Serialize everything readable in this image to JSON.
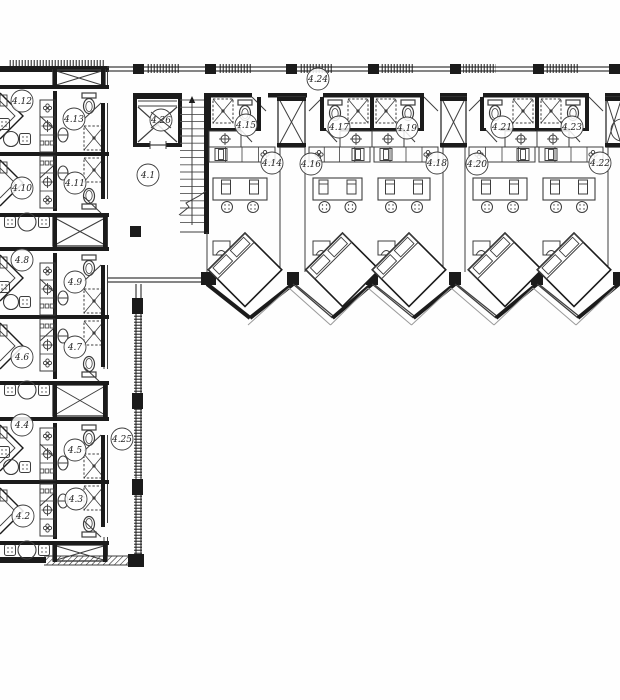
{
  "plan": {
    "type": "architectural-floor-plan",
    "colors": {
      "wall": "#1b1b1b",
      "line": "#3d3d3d",
      "mid": "#555555",
      "light": "#9a9a9a",
      "bg": "#fefefe"
    },
    "corridor_top_label": "4.24",
    "corridor_left_label": "4.25",
    "lobby_label": "4.1",
    "elevator_label": "4.26",
    "room_labels": [
      {
        "id": "4.1",
        "x": 148,
        "y": 175
      },
      {
        "id": "4.2",
        "x": 23,
        "y": 516
      },
      {
        "id": "4.3",
        "x": 76,
        "y": 499
      },
      {
        "id": "4.4",
        "x": 22,
        "y": 425
      },
      {
        "id": "4.5",
        "x": 75,
        "y": 450
      },
      {
        "id": "4.6",
        "x": 22,
        "y": 357
      },
      {
        "id": "4.7",
        "x": 75,
        "y": 347
      },
      {
        "id": "4.8",
        "x": 22,
        "y": 260
      },
      {
        "id": "4.9",
        "x": 75,
        "y": 282
      },
      {
        "id": "4.10",
        "x": 22,
        "y": 188
      },
      {
        "id": "4.11",
        "x": 75,
        "y": 183
      },
      {
        "id": "4.12",
        "x": 22,
        "y": 101
      },
      {
        "id": "4.13",
        "x": 74,
        "y": 119
      },
      {
        "id": "4.14",
        "x": 272,
        "y": 163
      },
      {
        "id": "4.15",
        "x": 246,
        "y": 125
      },
      {
        "id": "4.16",
        "x": 311,
        "y": 164
      },
      {
        "id": "4.17",
        "x": 339,
        "y": 127
      },
      {
        "id": "4.18",
        "x": 437,
        "y": 163
      },
      {
        "id": "4.19",
        "x": 407,
        "y": 128
      },
      {
        "id": "4.20",
        "x": 477,
        "y": 164
      },
      {
        "id": "4.21",
        "x": 502,
        "y": 127
      },
      {
        "id": "4.22",
        "x": 600,
        "y": 163
      },
      {
        "id": "4.23",
        "x": 572,
        "y": 127
      },
      {
        "id": "4.24",
        "x": 318,
        "y": 79
      },
      {
        "id": "4.25",
        "x": 122,
        "y": 439
      },
      {
        "id": "4.26",
        "x": 161,
        "y": 120,
        "crossed": true
      }
    ]
  }
}
